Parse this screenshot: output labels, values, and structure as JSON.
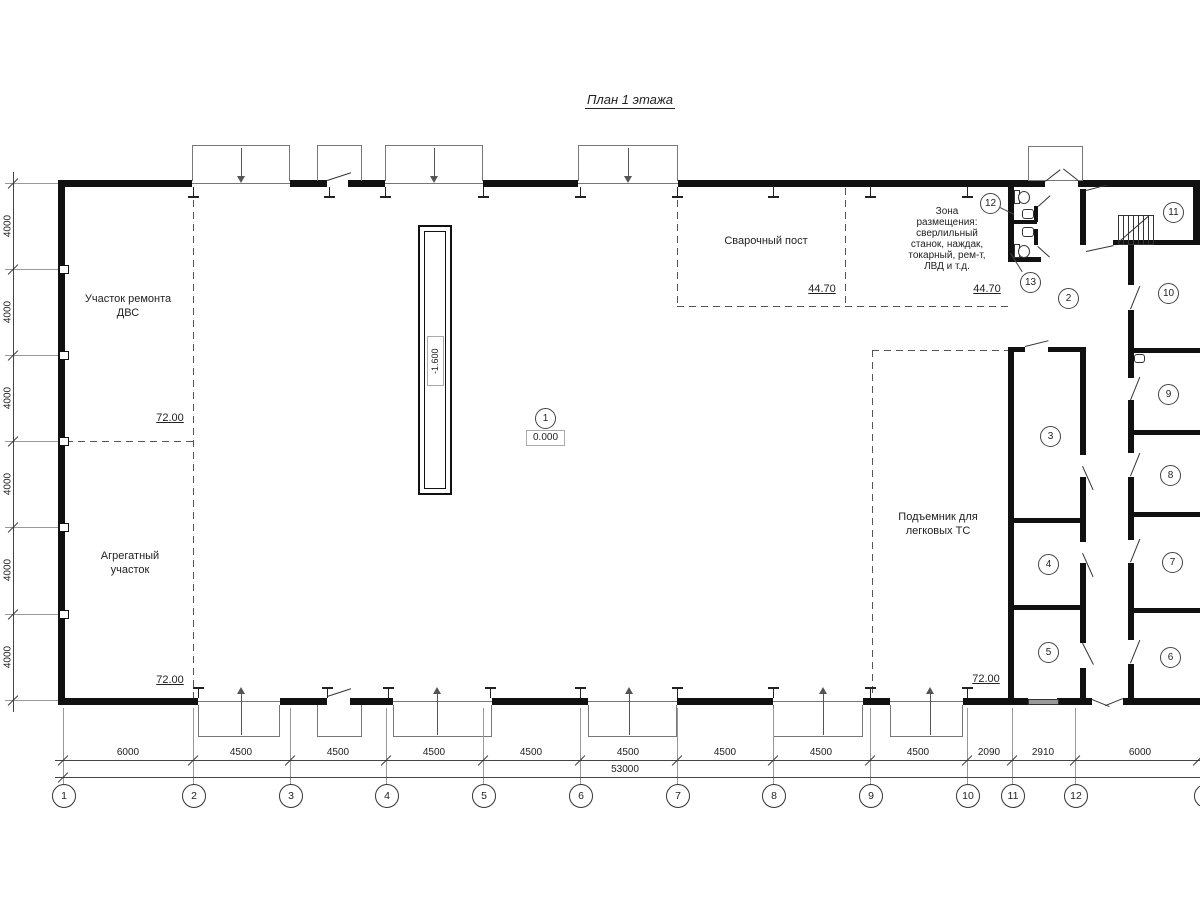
{
  "title": "План 1 этажа",
  "rooms": {
    "engine_repair": {
      "label": "Участок ремонта\nДВС",
      "area": "72.00"
    },
    "aggregate": {
      "label": "Агрегатный\nучасток",
      "area": "72.00"
    },
    "welding": {
      "label": "Сварочный пост",
      "area": "44.70"
    },
    "equipment_zone": {
      "label": "Зона\nразмещения:\nсверлильный\nстанок, наждак,\nтокарный, рем-т,\nЛВД и т.д.",
      "area": "44.70"
    },
    "car_lift": {
      "label": "Подъемник для\nлегковых ТС",
      "area": "72.00"
    }
  },
  "elevations": {
    "floor": "0.000",
    "pit": "-1.600"
  },
  "room_numbers": [
    "1",
    "2",
    "3",
    "4",
    "5",
    "6",
    "7",
    "8",
    "9",
    "10",
    "11",
    "12",
    "13"
  ],
  "axes": {
    "numbers": [
      "1",
      "2",
      "3",
      "4",
      "5",
      "6",
      "7",
      "8",
      "9",
      "10",
      "11",
      "12",
      "13"
    ],
    "spacings": [
      "6000",
      "4500",
      "4500",
      "4500",
      "4500",
      "4500",
      "4500",
      "4500",
      "4500",
      "2090",
      "2910",
      "6000"
    ],
    "total": "53000",
    "row_spacings": [
      "4000",
      "4000",
      "4000",
      "4000",
      "4000",
      "4000"
    ]
  }
}
